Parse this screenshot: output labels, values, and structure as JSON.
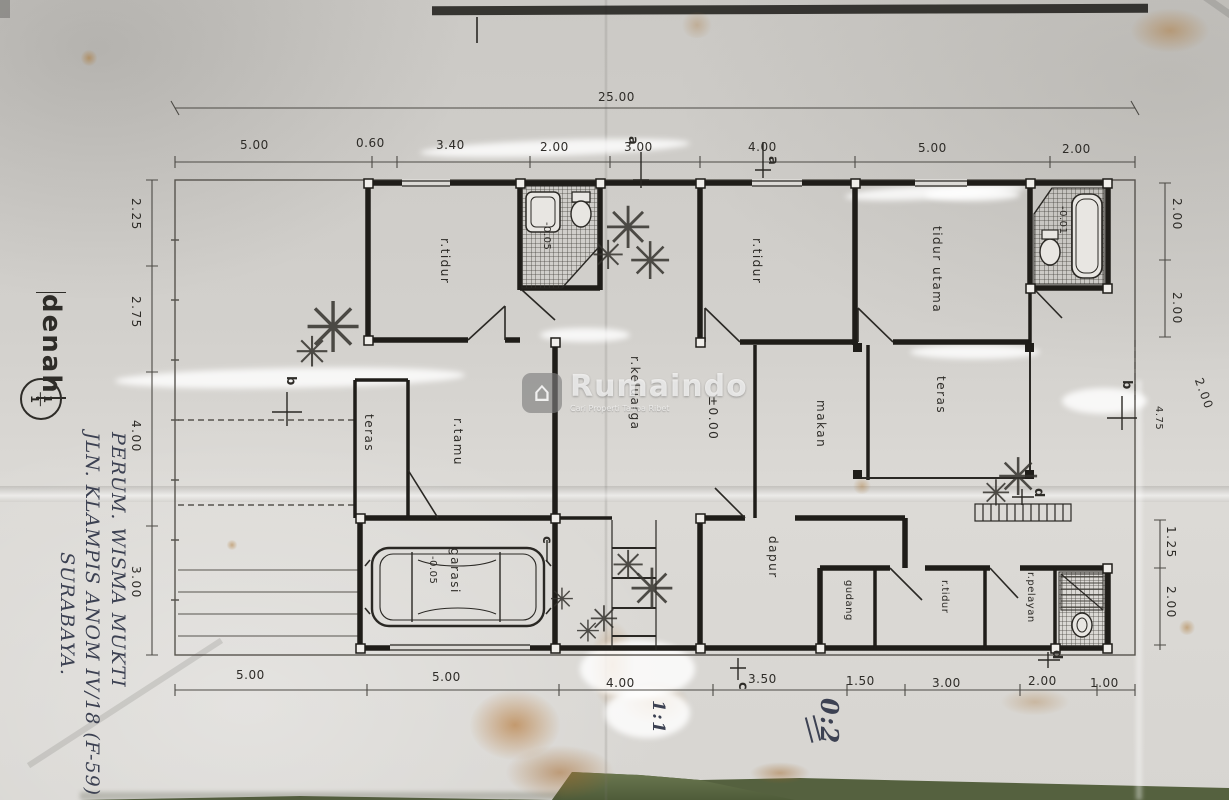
{
  "photo": {
    "description": "Photograph of a hand-drafted house floor plan on creased paper",
    "paper_color": "#d2d0cc",
    "ink_color": "#2e2c28",
    "table_color": "#55613f"
  },
  "watermark": {
    "brand": "Rumaindo",
    "tagline": "Cari Properti Tanpa Ribet"
  },
  "title_block": {
    "title": "denah",
    "scale_numerator": "1",
    "scale_denominator": "1"
  },
  "handwriting": {
    "line1": "PERUM. WISMA MUKTI",
    "line2": "JLN. KLAMPIS ANOM IV/18 (F-59)",
    "line3": "SURABAYA.",
    "note_left": "1:1",
    "note_right": "0:2"
  },
  "dimensions": {
    "top_total": "25.00",
    "top": [
      "5.00",
      "0.60",
      "3.40",
      "2.00",
      "3.00",
      "4.00",
      "5.00",
      "2.00"
    ],
    "bottom": [
      "5.00",
      "5.00",
      "4.00",
      "3.50",
      "1.50",
      "3.00",
      "2.00",
      "1.00"
    ],
    "left": [
      "2.25",
      "2.75",
      "4.00",
      "3.00"
    ],
    "right_upper": [
      "2.00",
      "2.00"
    ],
    "right_mid": "2.00",
    "right_marker_offset": "4.75",
    "right_lower": [
      "1.25",
      "2.00"
    ]
  },
  "rooms": {
    "bedroom_front": "r.tidur",
    "bedroom_middle": "r.tidur",
    "master_bedroom": "tidur utama",
    "family_room": "r.keluarga",
    "living_room": "r.tamu",
    "dining_room": "makan",
    "terrace_left": "teras",
    "terrace_right": "teras",
    "garage": "garasi",
    "kitchen": "dapur",
    "storage": "gudang",
    "bedroom_back": "r.tidur",
    "maid_room": "r.pelayan"
  },
  "levels": {
    "main": "±0.00",
    "garage": "-0.05",
    "bath_front": "-0.05",
    "bath_master": "-0.01"
  },
  "section_markers": {
    "a": "a",
    "b": "b",
    "c": "c",
    "d": "d"
  }
}
